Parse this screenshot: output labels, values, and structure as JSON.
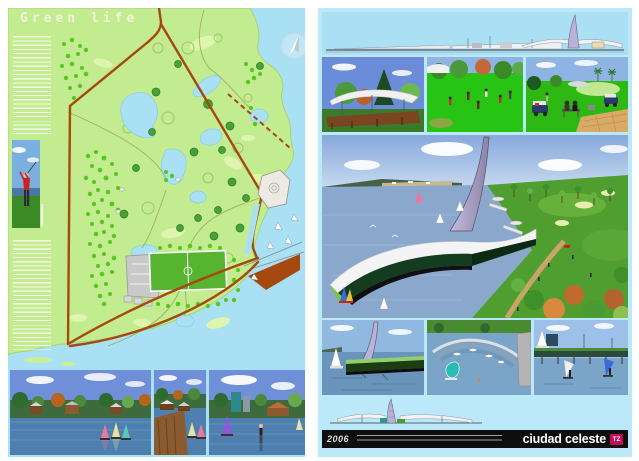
{
  "left_panel": {
    "title": "Green life"
  },
  "footer": {
    "year": "2006",
    "brand": "ciudad celeste",
    "logo_text": "TZ"
  },
  "colors": {
    "page-bg": "#ffffff",
    "water-left": "#a9e0f4",
    "water-right": "#bce9fa",
    "land": "#c3eb8f",
    "tree": "#55c81e",
    "road": "#a6490f",
    "pond": "#a9e0f4",
    "field": "#56b430",
    "bar-bg": "#0e0e0e",
    "logo-bg": "#c60a55",
    "title-color": "#f2f4da",
    "sail-spire": "#b9b1d6"
  },
  "icons": {
    "compass": "circle-with-needle",
    "sail_spire": "curved-sail-tower",
    "sailboat": "triangle-sail"
  }
}
